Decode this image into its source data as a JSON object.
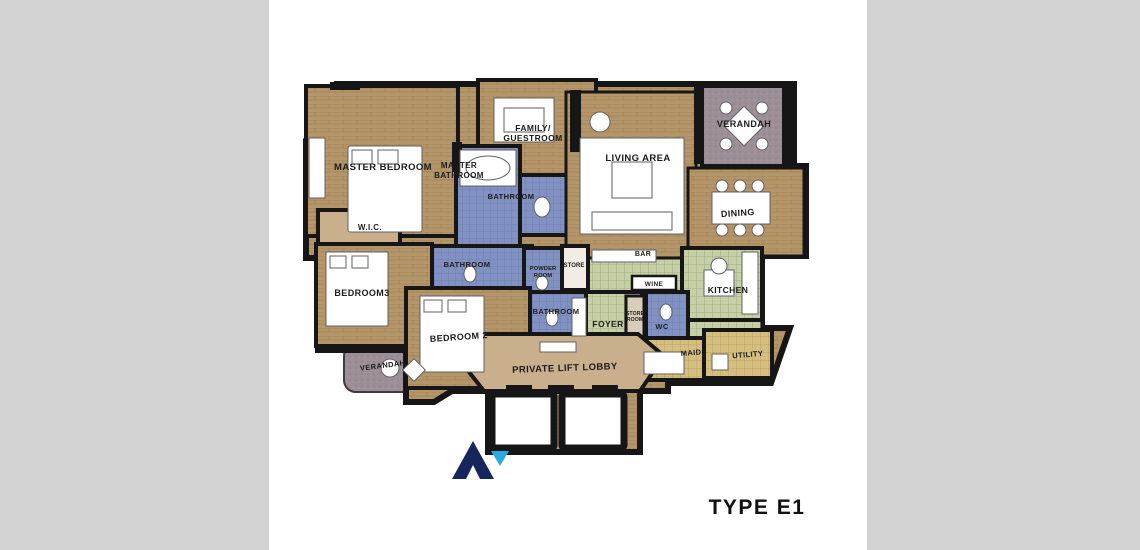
{
  "page": {
    "type_label": "TYPE E1"
  },
  "colors": {
    "background": "#d2d2d2",
    "canvas": "#ffffff",
    "wall": "#161616",
    "wood": "#b5956a",
    "tan": "#c9af8c",
    "blue_tile": "#8191c1",
    "green_tile": "#c6cfa6",
    "khaki_tile": "#d5bf80",
    "mauve": "#9c8f98",
    "logo_navy": "#16255c",
    "logo_cyan": "#2aace3"
  },
  "rooms": {
    "master_bedroom": "MASTER BEDROOM",
    "master_bathroom_line1": "MASTER",
    "master_bathroom_line2": "BATHROOM",
    "family_guestroom_line1": "FAMILY/",
    "family_guestroom_line2": "GUESTROOM",
    "bathroom_top": "BATHROOM",
    "wic": "W.I.C.",
    "living_area": "LIVING AREA",
    "verandah_top": "VERANDAH",
    "dining": "DINING",
    "bar": "BAR",
    "wine": "WINE",
    "kitchen": "KITCHEN",
    "bathroom_mid": "BATHROOM",
    "powder_room_line1": "POWDER",
    "powder_room_line2": "ROOM",
    "store": "STORE",
    "bedroom3": "BEDROOM3",
    "bedroom2": "BEDROOM 2",
    "bathroom_lower": "BATHROOM",
    "foyer": "FOYER",
    "store_room_line1": "STORE",
    "store_room_line2": "ROOM",
    "wc": "WC",
    "maids": "MAIDS",
    "utility": "UTILITY",
    "verandah_bottom": "VERANDAH",
    "private_lift_lobby": "PRIVATE LIFT LOBBY"
  }
}
